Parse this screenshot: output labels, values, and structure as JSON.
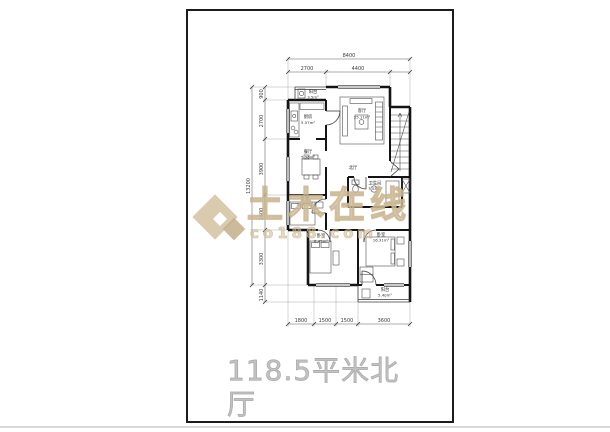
{
  "sheet": {
    "title": "118.5平米北厅"
  },
  "watermark": {
    "brand": "土木在线",
    "domain": "co188.com"
  },
  "plan": {
    "hall_label": "北厅",
    "rooms": [
      {
        "name": "阳台",
        "area": "3.5m²"
      },
      {
        "name": "厨房",
        "area": "5.57m²"
      },
      {
        "name": "餐厅",
        "area": "5.96m²"
      },
      {
        "name": "客厅",
        "area": "25.11m²"
      },
      {
        "name": "卧室",
        "area": "10.61m²"
      },
      {
        "name": "卫生间",
        "area": "7.53m²"
      },
      {
        "name": "卧室",
        "area": "8.45m²"
      },
      {
        "name": "卧室",
        "area": "16.31m²"
      },
      {
        "name": "阳台",
        "area": "5.40m²"
      }
    ],
    "dims": {
      "top_total": "8400",
      "top_segments": [
        "2700",
        "4400"
      ],
      "left_total": "13200",
      "left_segments": [
        "900",
        "2700",
        "3900",
        "2400",
        "3300",
        "1140"
      ],
      "bottom_segments": [
        "1800",
        "1500",
        "1500",
        "3600"
      ]
    }
  },
  "colors": {
    "wall": "#141414",
    "dimension": "#5a5a5a",
    "watermark_tan": "#d0b995",
    "title_gray": "#c2c2c2"
  }
}
